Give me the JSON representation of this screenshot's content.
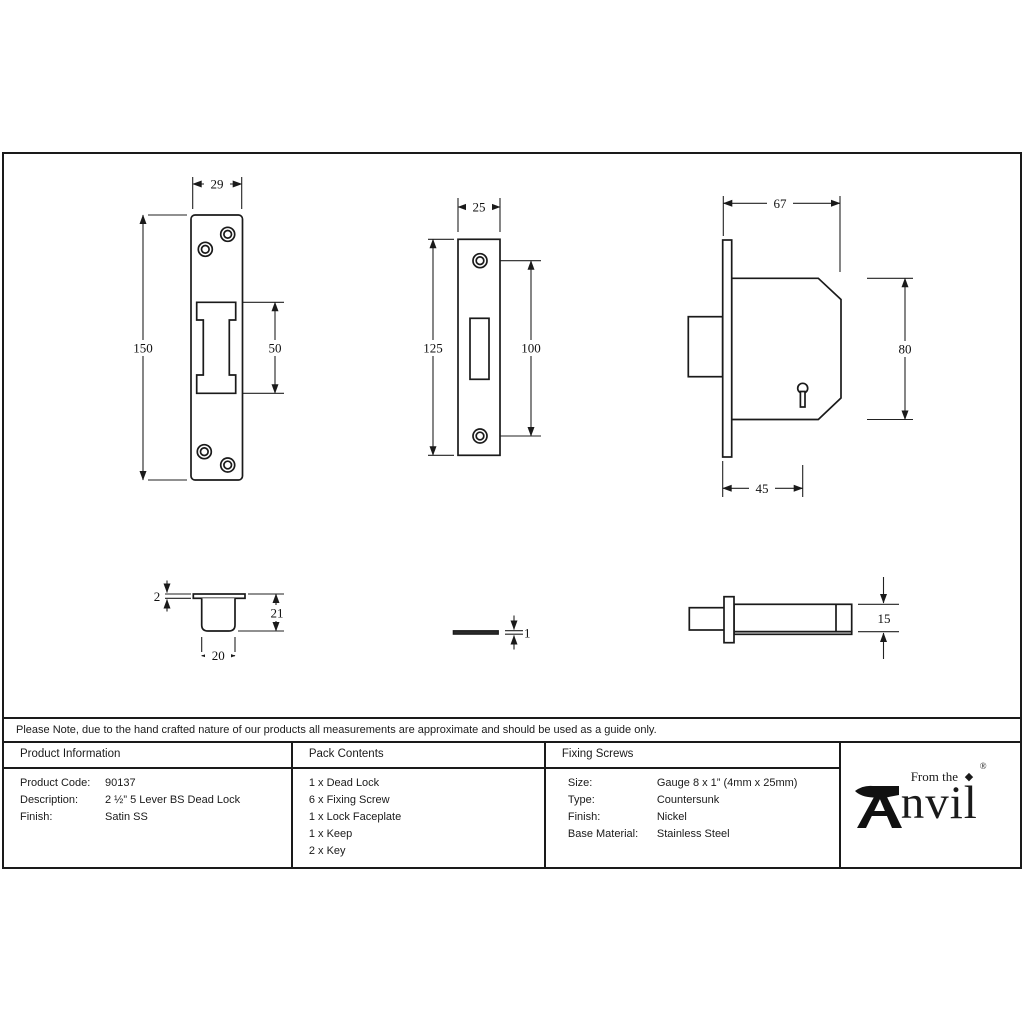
{
  "note": "Please Note, due to the hand crafted nature of our products all measurements are approximate and should be used as a guide only.",
  "table": {
    "product_information": {
      "header": "Product Information",
      "rows": [
        {
          "label": "Product Code:",
          "value": "90137"
        },
        {
          "label": "Description:",
          "value": "2 ½” 5 Lever BS Dead Lock"
        },
        {
          "label": "Finish:",
          "value": "Satin SS"
        }
      ]
    },
    "pack_contents": {
      "header": "Pack Contents",
      "items": [
        "1 x Dead Lock",
        "6 x Fixing Screw",
        "1 x Lock Faceplate",
        "1 x Keep",
        "2 x Key"
      ]
    },
    "fixing_screws": {
      "header": "Fixing Screws",
      "rows": [
        {
          "label": "Size:",
          "value": "Gauge 8 x 1” (4mm x 25mm)"
        },
        {
          "label": "Type:",
          "value": "Countersunk"
        },
        {
          "label": "Finish:",
          "value": "Nickel"
        },
        {
          "label": "Base Material:",
          "value": "Stainless Steel"
        }
      ]
    }
  },
  "brand": {
    "tagline": "From the",
    "wordmark": "nvil",
    "registered": "®",
    "mini_icon": "◆"
  },
  "dims": {
    "keep_front": {
      "width": "29",
      "height": "150",
      "cutout_height": "50"
    },
    "faceplate_front": {
      "width": "25",
      "height": "125",
      "hole_spacing": "100"
    },
    "lock_front": {
      "depth": "67",
      "height": "80",
      "backset": "45"
    },
    "keep_side": {
      "lip": "2",
      "height": "21",
      "width": "20"
    },
    "faceplate_side": {
      "thickness": "1"
    },
    "lock_side": {
      "thickness": "15"
    }
  },
  "colors": {
    "line": "#1a1a1a",
    "text": "#1a1a1a",
    "background": "#ffffff"
  }
}
